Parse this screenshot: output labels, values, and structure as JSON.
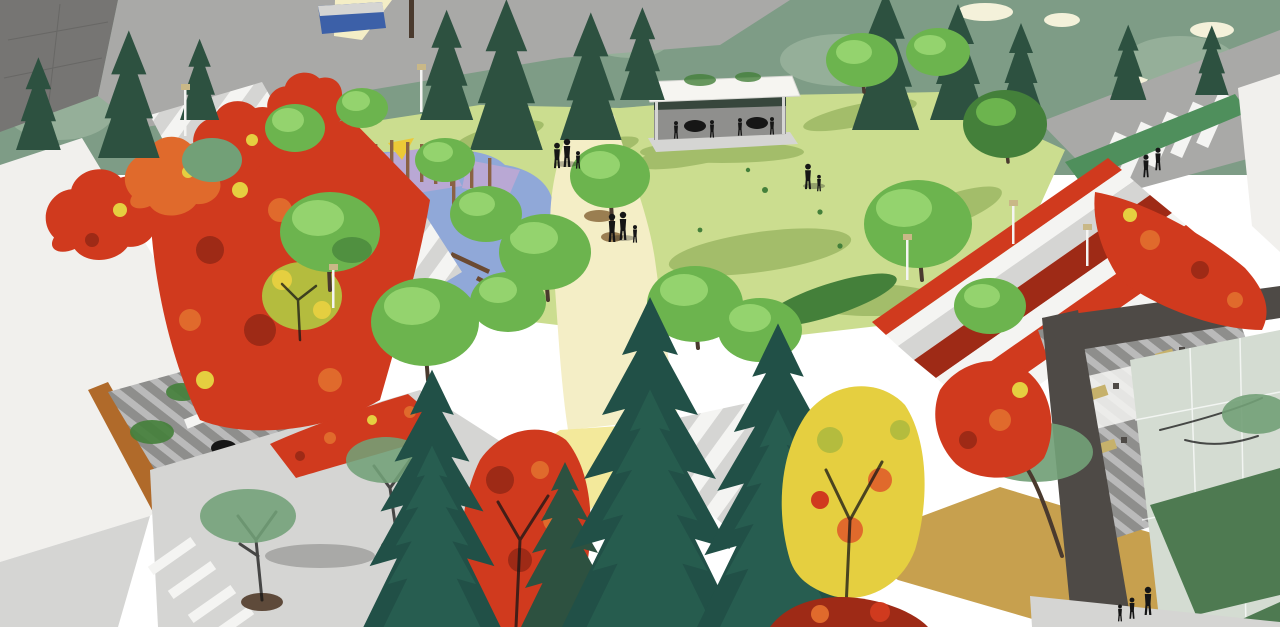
{
  "meta": {
    "title": "Aerial architectural rendering of a triangular neighbourhood park in autumn",
    "media_type": "3d-rendering",
    "canvas": {
      "width": 1280,
      "height": 627
    },
    "season": "autumn",
    "view": "aerial-perspective"
  },
  "scene": {
    "description": "Bird's-eye SketchUp-style rendering: a yellow-green lawn bounded by terraced steps and bands of red maples, a white-roofed cafe pavilion with seated figures, a playground with blue safety surface, lavender platforms, yellow shade sails and timber posts, cream and yellow pedestrian paths with walking families, surrounding streets, plazas, rooftop terraces with outdoor furniture, white residential buildings at the corners, and tall dark-teal conifers in the foreground.",
    "features": [
      {
        "name": "backdrop-tree-canopy",
        "note": "muted sage canopy with dark conifer silhouettes and cream sky gaps"
      },
      {
        "name": "top-left-street",
        "note": "grey roadway with blue transit shelter and cream path"
      },
      {
        "name": "top-right-crosswalk",
        "note": "white zebra stripes, hedge median, two pedestrians"
      },
      {
        "name": "central-lawn",
        "note": "yellow-green grass with long tree shadows, adult and child figures"
      },
      {
        "name": "cafe-pavilion",
        "note": "flat white roof, grey interior, silhouettes seated at two round tables"
      },
      {
        "name": "playground",
        "note": "blue rubber surface, lavender platforms, two yellow shade sails, timber post grove, log balance beams"
      },
      {
        "name": "main-path",
        "note": "cream path with two walking families and leaf litter"
      },
      {
        "name": "yellow-path",
        "note": "pale yellow diagonal promenade toward bottom-left"
      },
      {
        "name": "ochre-path",
        "note": "tan path at bottom-right with walking family"
      },
      {
        "name": "terraced-steps-left",
        "note": "striped ramp through dense red and chartreuse maples"
      },
      {
        "name": "terraced-steps-right",
        "note": "white step bands alternating with crimson shrub strips, light poles, two people seated"
      },
      {
        "name": "left-building-roof-terrace",
        "note": "grey decking, black round table, white sofas, planters, orange accent wall"
      },
      {
        "name": "bottom-left-plaza",
        "note": "light plaza, crosswalk bars, street trees in circular pits"
      },
      {
        "name": "right-cafe-deck",
        "note": "khaki tables and chairs on striped grey decking under dark building frame"
      },
      {
        "name": "bottom-right-building",
        "note": "white glass facade, dark frame, dark green lawn panels, sidewalk with family"
      },
      {
        "name": "foreground-conifers",
        "note": "three tall layered dark-teal firs"
      },
      {
        "name": "foreground-autumn-trees",
        "note": "red maple and yellow-leaf tree masses"
      }
    ],
    "people_groups": [
      {
        "name": "pavilion-diners",
        "count": 4
      },
      {
        "name": "path-family-upper",
        "count": 3
      },
      {
        "name": "path-family-mid",
        "count": 3
      },
      {
        "name": "lawn-pair",
        "count": 2
      },
      {
        "name": "plaza-pair",
        "count": 2
      },
      {
        "name": "steps-sitters",
        "count": 2
      },
      {
        "name": "crosswalk-walkers",
        "count": 2
      },
      {
        "name": "sidewalk-family-bottom-right",
        "count": 3
      },
      {
        "name": "upper-plaza-pair",
        "count": 2
      }
    ]
  },
  "palette": {
    "sky_cream": "#f4f1da",
    "backdrop_foliage": "#7e9c86",
    "backdrop_foliage_light": "#95af99",
    "backdrop_dark_conifer": "#2d5140",
    "canopy_green": "#6cb44e",
    "canopy_green_light": "#94d36e",
    "canopy_green_dark": "#44803a",
    "street_tree_green": "#72a077",
    "lawn": "#cbdd8f",
    "lawn_shadow": "#a3bd6a",
    "dark_lawn_panel": "#4e7a51",
    "path_cream": "#f4eec6",
    "path_yellow": "#f3e99b",
    "path_ochre": "#c7a04e",
    "leaf_litter_brown": "#8a6a3c",
    "street_grey": "#a9a9a7",
    "plaza_light": "#d5d5d3",
    "paving_white": "#f4f4f2",
    "building_white": "#f1f0ed",
    "building_grey": "#767573",
    "frame_dark": "#4e4a46",
    "glass_pale": "#d4dcd2",
    "deck_grey": "#8e8e8c",
    "deck_light": "#bababa",
    "accent_orange": "#b06a2a",
    "maple_red": "#d03a1e",
    "maple_orange": "#e06a2c",
    "maple_yellow": "#e5cf40",
    "autumn_chartreuse": "#b4bc3e",
    "shrub_crimson": "#9e2a16",
    "conifer_teal": "#215047",
    "conifer_teal_light": "#2f6d5a",
    "trunk_brown": "#6b4a32",
    "trunk_dark": "#4a3a2e",
    "play_surface_blue": "#90a8d8",
    "play_platform_lavender": "#b9a8d4",
    "play_sail_yellow": "#ecc937",
    "play_post_brown": "#8a6244",
    "pavilion_roof": "#f6f5f1",
    "pavilion_wall": "#8f8f8d",
    "pavilion_band": "#37463c",
    "silhouette": "#161616",
    "tree_pit": "#5e4a3a",
    "shelter_blue": "#3c60a8",
    "pole_tan": "#c9b887",
    "hedge_green": "#4f8f5c",
    "table_khaki": "#c6b16b"
  }
}
